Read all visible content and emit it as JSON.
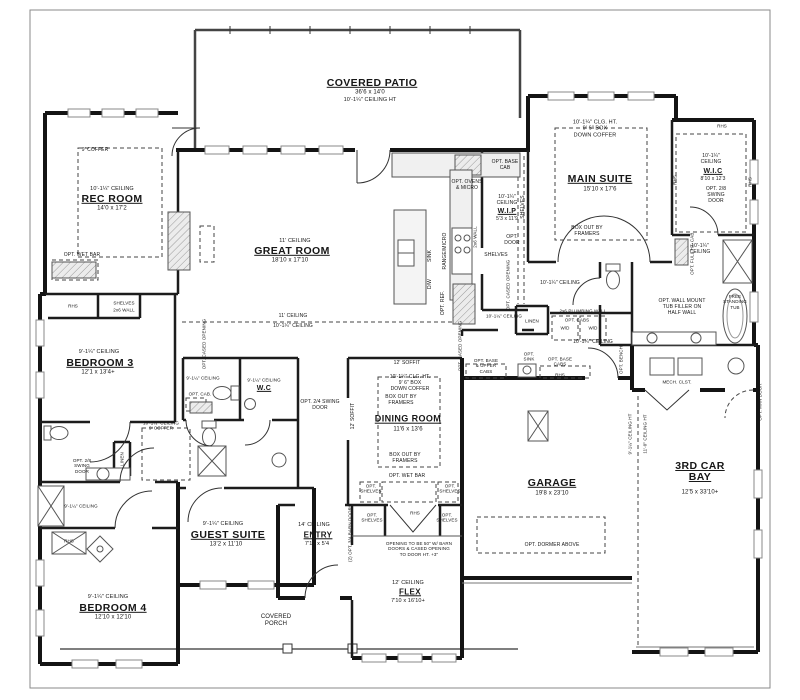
{
  "rooms": {
    "patio": {
      "name": "COVERED PATIO",
      "dims": "36'6 x 14'0",
      "ceil": "10'-1¼\" CEILING HT"
    },
    "rec": {
      "ceil": "10'-1¼\" CEILING",
      "name": "REC ROOM",
      "dims": "14'0 x 17'2",
      "coffer": "9' COFFER",
      "wetbar": "OPT. WET BAR"
    },
    "great": {
      "ceil": "11' CEILING",
      "name": "GREAT ROOM",
      "dims": "18'10 x 17'10",
      "split_hi": "11' CEILING",
      "split_lo": "10'-1¼\" CEILING"
    },
    "kitchen": {
      "ovens": "OPT. OVENS\n& MICRO",
      "base_cab": "OPT. BASE\nCAB",
      "range": "RANGE/MICRO",
      "ref": "OPT. REF.",
      "sink": "SINK",
      "dw": "D/W",
      "wall": "2x6 WALL"
    },
    "wip": {
      "ceil": "10'-1¼\"\nCEILING",
      "name": "W.I.P",
      "dims": "5'3 x 11'9",
      "door": "OPT.\nDOOR",
      "shelves": "SHELVES"
    },
    "suite": {
      "ceil": "10'-1¼\" CLG. HT.\n9' 6\" BOX\nDOWN COFFER",
      "name": "MAIN SUITE",
      "dims": "15'10 x 17'6",
      "box": "BOX OUT BY\nFRAMERS"
    },
    "wic": {
      "ceil": "10'-1¼\"\nCEILING",
      "name": "W.I.C",
      "dims": "8'10 x 12'3",
      "door": "OPT. 2/8\nSWING\nDOOR",
      "rhs": "RHS",
      "full_cab": "OPT. FULL HT. CAB."
    },
    "bath": {
      "ceil": "10'-1¼\"\nCEILING",
      "tub_note": "OPT. WALL MOUNT\nTUB FILLER ON\nHALF WALL",
      "free_tub": "FREE\nSTANDING\nTUB",
      "bench": "OPT.\nBENCH"
    },
    "laundry": {
      "plumb": "2x6 PLUMBING WALL",
      "cabs": "OPT. CABS",
      "wd": "W/D",
      "linen": "LINEN",
      "ceil": "10'-1¼\" CEILING",
      "sink": "OPT.\nSINK",
      "base_cabs": "OPT. BASE\nCABS",
      "base_upper": "OPT. BASE\n& UPPER\nCABS",
      "rhs": "RHS",
      "cased": "OPT. CASED OPENING"
    },
    "dining": {
      "ceil": "10'-1¼\" CLG. HT.\n9' 6\" BOX\nDOWN COFFER",
      "name": "DINING ROOM",
      "dims": "11'6 x 13'6",
      "box": "BOX OUT BY\nFRAMERS",
      "wetbar": "OPT. WET BAR",
      "shelves": "OPT.\nSHELVES",
      "soffit": "12' SOFFIT"
    },
    "bed3": {
      "ceil": "9'-1¼\" CEILING",
      "name": "BEDROOM 3",
      "dims": "12'1 x 13'4+"
    },
    "bed4": {
      "ceil": "9'-1¼\" CEILING",
      "name": "BEDROOM 4",
      "dims": "12'10 x 12'10"
    },
    "guest": {
      "ceil": "9'-1¼\" CEILING",
      "name": "GUEST SUITE",
      "dims": "13'2 x 11'10"
    },
    "entry": {
      "ceil": "14' CEILING",
      "name": "ENTRY",
      "dims": "7'10 x 5'4"
    },
    "flex": {
      "ceil": "12' CEILING",
      "name": "FLEX",
      "dims": "7'10 x 16'10+",
      "opening": "OPENING TO BE 50\" W/ BARN\nDOORS & CASED OPENING\nTO DOOR HT. +3\"",
      "barn": "(2) OPT. 3/4 BARN DOORS",
      "shelves": "OPT.\nSHELVES",
      "rhs": "RHS"
    },
    "garage": {
      "name": "GARAGE",
      "dims": "19'8 x 23'10",
      "dormer": "OPT. DORMER ABOVE",
      "ceil9": "9'-1¼\" CEILING HT",
      "ceil11": "11'-0\" CEILING HT"
    },
    "bay": {
      "name": "3RD CAR BAY",
      "dims": "12'5 x 33'10+",
      "man_door": "OPT. MAN DOOR"
    },
    "mech": {
      "name": "MECH. CLST."
    },
    "porch": {
      "name": "COVERED\nPORCH"
    },
    "wc": {
      "ceil": "9'-1¼\" CEILING",
      "name": "W.C",
      "swing": "OPT. 2/4 SWING\nDOOR",
      "cab": "OPT. CAB."
    },
    "hall": {
      "coffer": "10'-1¼\" CEILING\n9' COFFER",
      "cased": "OPT. CASED OPENING",
      "linen": "LINEN",
      "swing": "OPT. 2/8\nSWING\nDOOR",
      "ceil9": "9'-1¼\" CEILING",
      "shelves": "SHELVES",
      "wall": "2x6 WALL",
      "rhs": "RHS",
      "ceil10": "10'-1¼\" CEILING"
    }
  }
}
